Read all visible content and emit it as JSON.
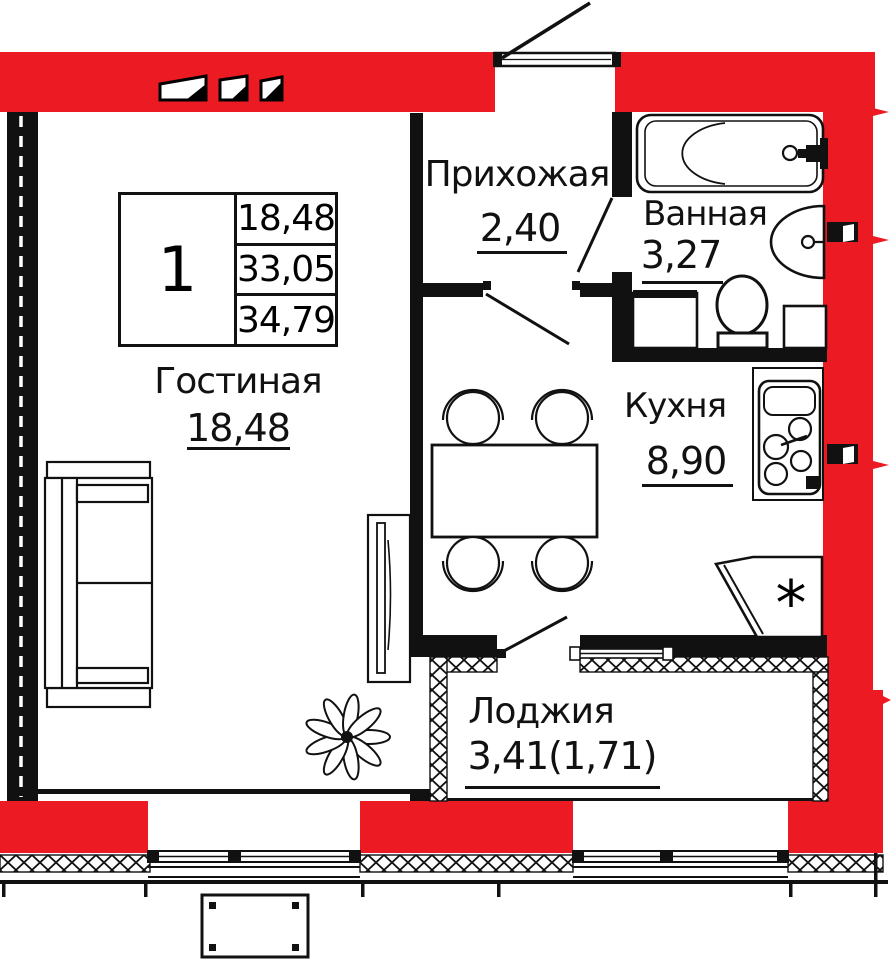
{
  "colors": {
    "accent_red": "#EC1B23",
    "line_black": "#111111"
  },
  "legend": {
    "rooms_count": "1",
    "row1": "18,48",
    "row2": "33,05",
    "row3": "34,79"
  },
  "rooms": {
    "living": {
      "name": "Гостиная",
      "area": "18,48"
    },
    "hall": {
      "name": "Прихожая",
      "area": "2,40"
    },
    "bath": {
      "name": "Ванная",
      "area": "3,27"
    },
    "kitchen": {
      "name": "Кухня",
      "area": "8,90"
    },
    "loggia": {
      "name": "Лоджия",
      "area": "3,41(1,71)"
    }
  },
  "symbols": {
    "fridge_star": "*"
  }
}
